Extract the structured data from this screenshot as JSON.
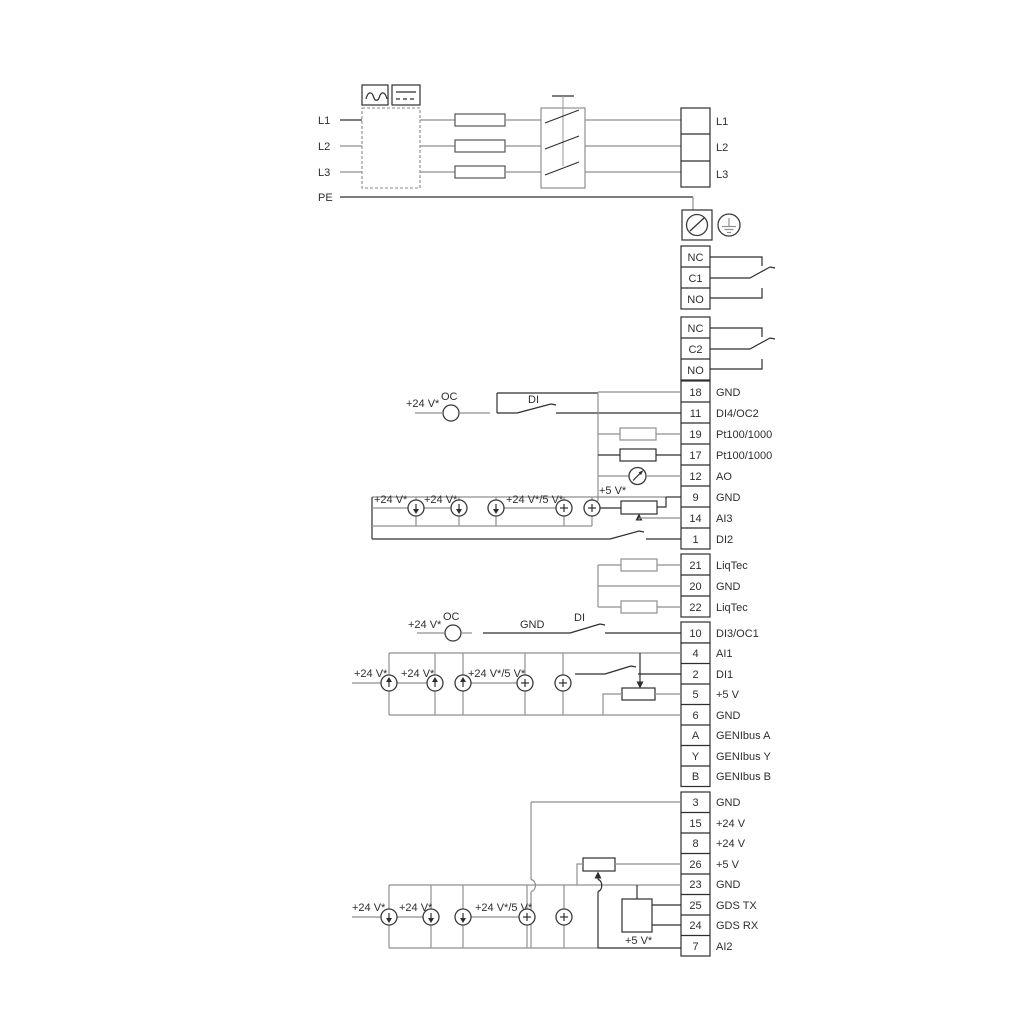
{
  "labels": {
    "v24": "+24 V*",
    "v24_5": "+24 V*/5 V*",
    "v5": "+5 V*",
    "oc": "OC",
    "di": "DI",
    "gnd": "GND"
  },
  "power_in": [
    "L1",
    "L2",
    "L3",
    "PE"
  ],
  "power_out": [
    "L1",
    "L2",
    "L3"
  ],
  "relay1": [
    "NC",
    "C1",
    "NO"
  ],
  "relay2": [
    "NC",
    "C2",
    "NO"
  ],
  "io_top": [
    {
      "num": "18",
      "label": "GND"
    },
    {
      "num": "11",
      "label": "DI4/OC2"
    },
    {
      "num": "19",
      "label": "Pt100/1000"
    },
    {
      "num": "17",
      "label": "Pt100/1000"
    },
    {
      "num": "12",
      "label": "AO"
    },
    {
      "num": "9",
      "label": "GND"
    },
    {
      "num": "14",
      "label": "AI3"
    },
    {
      "num": "1",
      "label": "DI2"
    }
  ],
  "liqtec": [
    {
      "num": "21",
      "label": "LiqTec"
    },
    {
      "num": "20",
      "label": "GND"
    },
    {
      "num": "22",
      "label": "LiqTec"
    }
  ],
  "di3": {
    "num": "10",
    "label": "DI3/OC1"
  },
  "io_mid": [
    {
      "num": "4",
      "label": "AI1"
    },
    {
      "num": "2",
      "label": "DI1"
    },
    {
      "num": "5",
      "label": "+5 V"
    },
    {
      "num": "6",
      "label": "GND"
    },
    {
      "num": "A",
      "label": "GENIbus A"
    },
    {
      "num": "Y",
      "label": "GENIbus Y"
    },
    {
      "num": "B",
      "label": "GENIbus B"
    }
  ],
  "io_bottom": [
    {
      "num": "3",
      "label": "GND"
    },
    {
      "num": "15",
      "label": "+24 V"
    },
    {
      "num": "8",
      "label": "+24 V"
    },
    {
      "num": "26",
      "label": "+5 V"
    },
    {
      "num": "23",
      "label": "GND"
    },
    {
      "num": "25",
      "label": "GDS TX"
    },
    {
      "num": "24",
      "label": "GDS RX"
    },
    {
      "num": "7",
      "label": "AI2"
    }
  ],
  "colors": {
    "wire_black": "#2e2e2e",
    "wire_gray": "#8f8f8f",
    "background": "#ffffff"
  }
}
